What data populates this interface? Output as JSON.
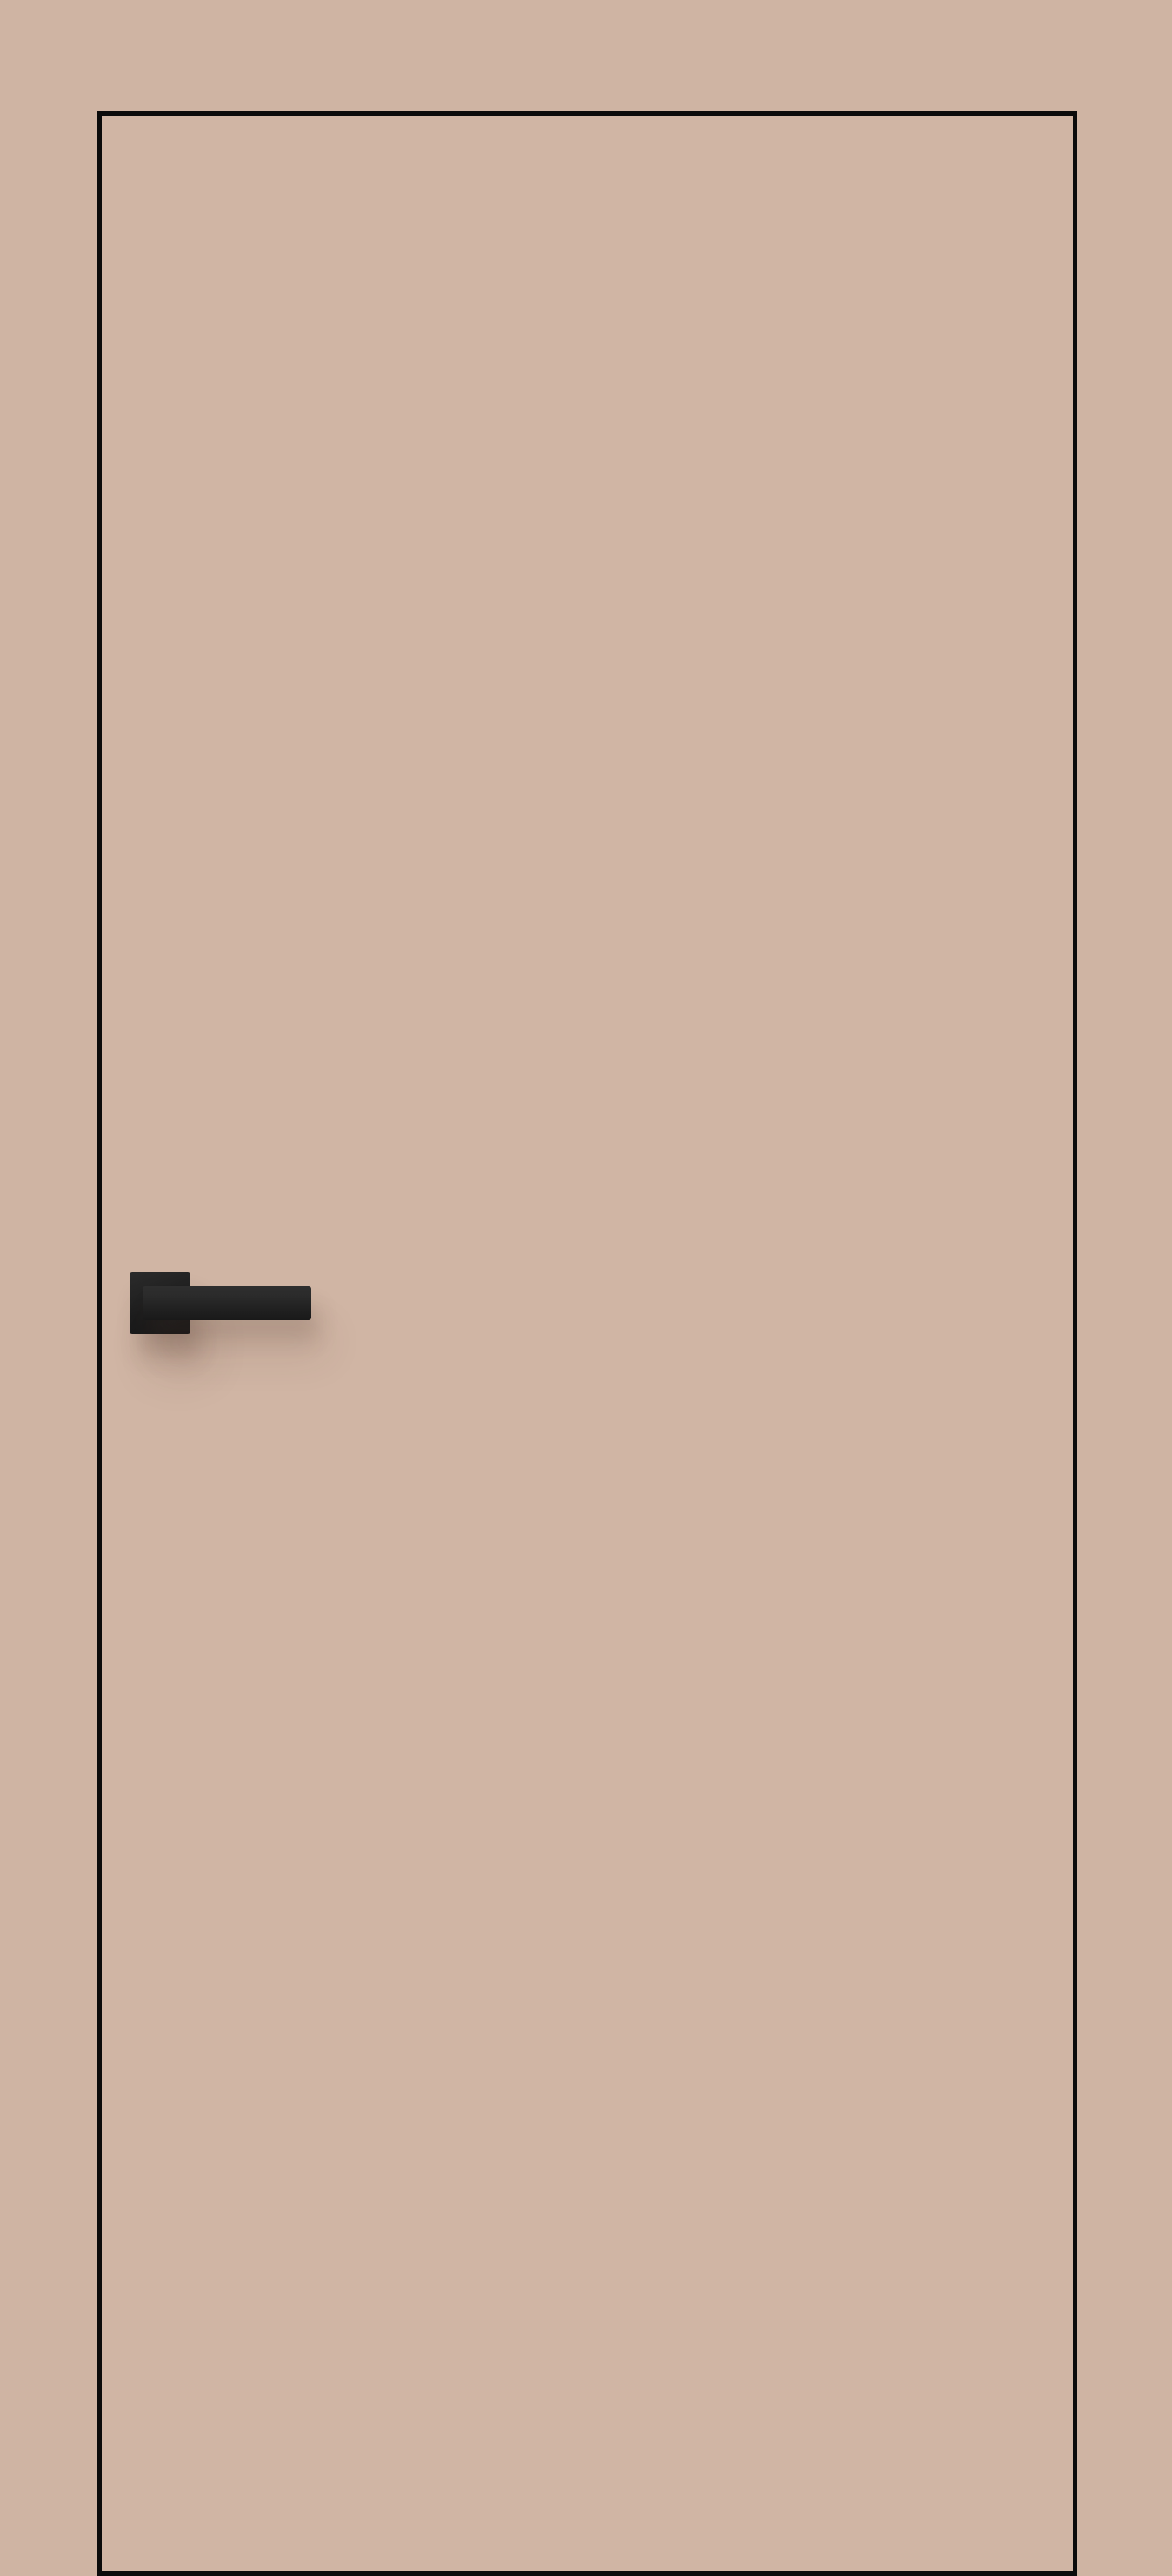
{
  "scene": {
    "subject": "closed interior door leaf, front view, flush flat panel",
    "elements": {
      "door_leaf": "flat cappuccino-beige door slab with thin black edge outline on all four sides, bottom edge reaching image bottom",
      "handle": "matte black door handle with square rose and straight rectangular lever pointing right, soft shadow cast below onto the door"
    }
  },
  "colors": {
    "background": "#cfb4a3",
    "door_panel": "#d0b5a4",
    "door_edge": "#0b0b0b",
    "handle_dark": "#1d1d1d",
    "handle_mid": "#2b2b2b",
    "shadow_soft": "rgba(74,50,38,0.18)",
    "shadow_faint": "rgba(74,50,38,0.10)"
  }
}
